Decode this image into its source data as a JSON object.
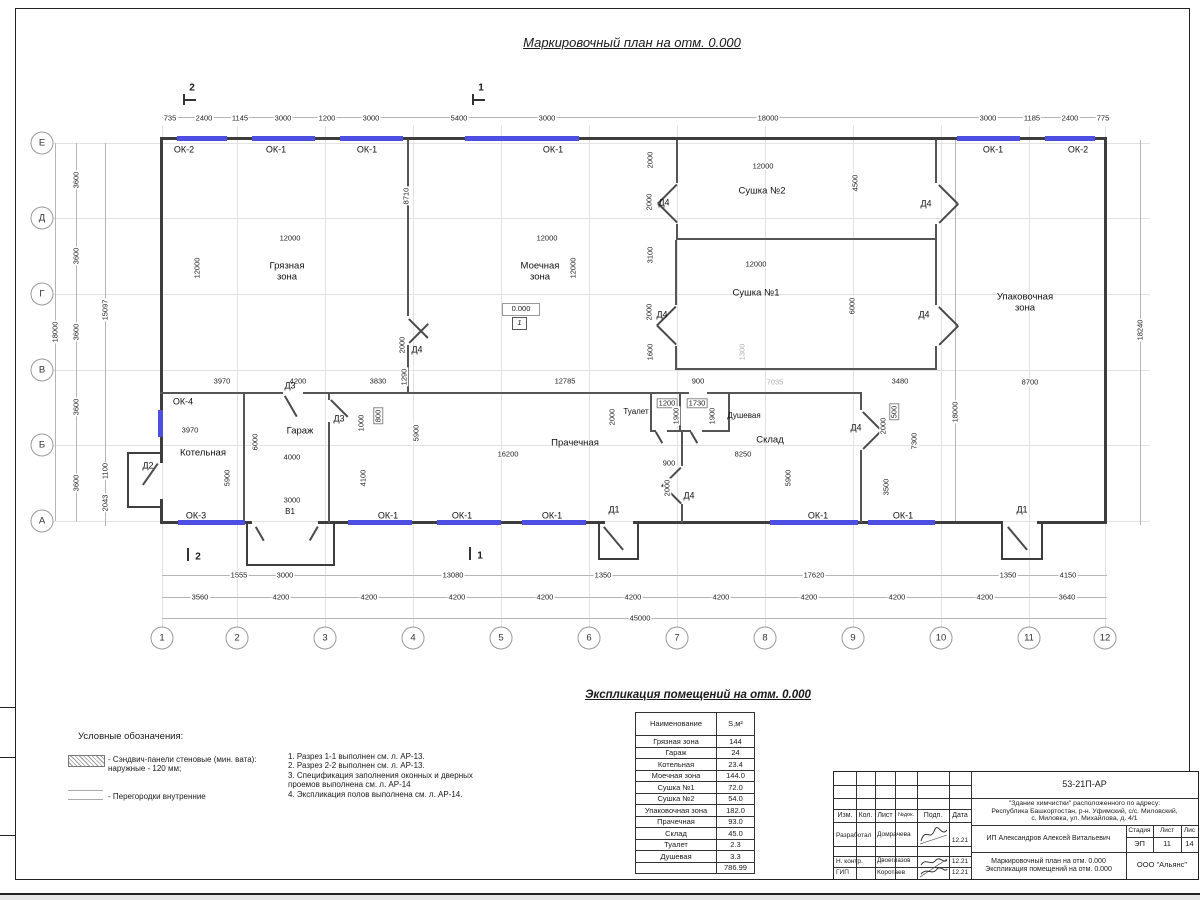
{
  "title": "Маркировочный план на отм. 0.000",
  "plan": {
    "axes_left": [
      {
        "l": "Е",
        "y": 143
      },
      {
        "l": "Д",
        "y": 218
      },
      {
        "l": "Г",
        "y": 294
      },
      {
        "l": "В",
        "y": 370
      },
      {
        "l": "Б",
        "y": 445
      },
      {
        "l": "А",
        "y": 521
      }
    ],
    "axes_bottom": [
      {
        "l": "1",
        "x": 162
      },
      {
        "l": "2",
        "x": 237
      },
      {
        "l": "3",
        "x": 325
      },
      {
        "l": "4",
        "x": 413
      },
      {
        "l": "5",
        "x": 501
      },
      {
        "l": "6",
        "x": 589
      },
      {
        "l": "7",
        "x": 677
      },
      {
        "l": "8",
        "x": 765
      },
      {
        "l": "9",
        "x": 853
      },
      {
        "l": "10",
        "x": 941
      },
      {
        "l": "11",
        "x": 1029
      },
      {
        "l": "12",
        "x": 1105
      }
    ],
    "rooms": [
      {
        "t": "Грязная\nзона",
        "x": 287,
        "y": 272
      },
      {
        "t": "Моечная\nзона",
        "x": 540,
        "y": 272
      },
      {
        "t": "Сушка №2",
        "x": 762,
        "y": 191
      },
      {
        "t": "Сушка №1",
        "x": 756,
        "y": 293
      },
      {
        "t": "Упаковочная\nзона",
        "x": 1025,
        "y": 303
      },
      {
        "t": "Котельная",
        "x": 203,
        "y": 453
      },
      {
        "t": "Гараж",
        "x": 300,
        "y": 431
      },
      {
        "t": "Прачечная",
        "x": 575,
        "y": 443
      },
      {
        "t": "Туалет",
        "x": 636,
        "y": 412,
        "s": 1
      },
      {
        "t": "Душевая",
        "x": 744,
        "y": 416,
        "s": 1
      },
      {
        "t": "Склад",
        "x": 770,
        "y": 440
      },
      {
        "t": "В1",
        "x": 290,
        "y": 512,
        "s": 1
      }
    ],
    "window_tags": [
      {
        "t": "ОК-2",
        "x": 184,
        "y": 150
      },
      {
        "t": "ОК-1",
        "x": 276,
        "y": 150
      },
      {
        "t": "ОК-1",
        "x": 367,
        "y": 150
      },
      {
        "t": "ОК-1",
        "x": 553,
        "y": 150
      },
      {
        "t": "ОК-1",
        "x": 993,
        "y": 150
      },
      {
        "t": "ОК-2",
        "x": 1078,
        "y": 150
      },
      {
        "t": "ОК-4",
        "x": 183,
        "y": 402
      },
      {
        "t": "ОК-3",
        "x": 196,
        "y": 516
      },
      {
        "t": "ОК-1",
        "x": 388,
        "y": 516
      },
      {
        "t": "ОК-1",
        "x": 462,
        "y": 516
      },
      {
        "t": "ОК-1",
        "x": 552,
        "y": 516
      },
      {
        "t": "ОК-1",
        "x": 818,
        "y": 516
      },
      {
        "t": "ОК-1",
        "x": 903,
        "y": 516
      }
    ],
    "door_tags": [
      {
        "t": "Д2",
        "x": 148,
        "y": 466
      },
      {
        "t": "Д3",
        "x": 290,
        "y": 386
      },
      {
        "t": "Д3",
        "x": 339,
        "y": 419
      },
      {
        "t": "Д4",
        "x": 417,
        "y": 350
      },
      {
        "t": "Д4",
        "x": 664,
        "y": 203
      },
      {
        "t": "Д4",
        "x": 926,
        "y": 204
      },
      {
        "t": "Д4",
        "x": 662,
        "y": 315
      },
      {
        "t": "Д4",
        "x": 924,
        "y": 315
      },
      {
        "t": "Д4",
        "x": 689,
        "y": 496
      },
      {
        "t": "Д4",
        "x": 856,
        "y": 428
      },
      {
        "t": "Д1",
        "x": 614,
        "y": 510
      },
      {
        "t": "Д1",
        "x": 1022,
        "y": 510
      }
    ],
    "dims": [
      {
        "t": "735",
        "x": 170,
        "y": 118
      },
      {
        "t": "2400",
        "x": 204,
        "y": 118
      },
      {
        "t": "1145",
        "x": 240,
        "y": 118
      },
      {
        "t": "3000",
        "x": 283,
        "y": 118
      },
      {
        "t": "1200",
        "x": 327,
        "y": 118
      },
      {
        "t": "3000",
        "x": 371,
        "y": 118
      },
      {
        "t": "5400",
        "x": 459,
        "y": 118
      },
      {
        "t": "3000",
        "x": 547,
        "y": 118
      },
      {
        "t": "18000",
        "x": 768,
        "y": 118
      },
      {
        "t": "3000",
        "x": 988,
        "y": 118
      },
      {
        "t": "1185",
        "x": 1032,
        "y": 118
      },
      {
        "t": "2400",
        "x": 1070,
        "y": 118
      },
      {
        "t": "775",
        "x": 1103,
        "y": 118
      },
      {
        "t": "1555",
        "x": 239,
        "y": 575
      },
      {
        "t": "3000",
        "x": 285,
        "y": 575
      },
      {
        "t": "13080",
        "x": 453,
        "y": 575
      },
      {
        "t": "1350",
        "x": 603,
        "y": 575
      },
      {
        "t": "17620",
        "x": 814,
        "y": 575
      },
      {
        "t": "1350",
        "x": 1008,
        "y": 575
      },
      {
        "t": "4150",
        "x": 1068,
        "y": 575
      },
      {
        "t": "3560",
        "x": 200,
        "y": 597
      },
      {
        "t": "4200",
        "x": 281,
        "y": 597
      },
      {
        "t": "4200",
        "x": 369,
        "y": 597
      },
      {
        "t": "4200",
        "x": 457,
        "y": 597
      },
      {
        "t": "4200",
        "x": 545,
        "y": 597
      },
      {
        "t": "4200",
        "x": 633,
        "y": 597
      },
      {
        "t": "4200",
        "x": 721,
        "y": 597
      },
      {
        "t": "4200",
        "x": 809,
        "y": 597
      },
      {
        "t": "4200",
        "x": 897,
        "y": 597
      },
      {
        "t": "4200",
        "x": 985,
        "y": 597
      },
      {
        "t": "3640",
        "x": 1067,
        "y": 597
      },
      {
        "t": "45000",
        "x": 640,
        "y": 618
      },
      {
        "t": "18000",
        "x": 55,
        "y": 332,
        "r": 1
      },
      {
        "t": "3600",
        "x": 76,
        "y": 180,
        "r": 1
      },
      {
        "t": "3600",
        "x": 76,
        "y": 256,
        "r": 1
      },
      {
        "t": "3600",
        "x": 76,
        "y": 332,
        "r": 1
      },
      {
        "t": "3600",
        "x": 76,
        "y": 407,
        "r": 1
      },
      {
        "t": "3600",
        "x": 76,
        "y": 483,
        "r": 1
      },
      {
        "t": "15097",
        "x": 105,
        "y": 310,
        "r": 1
      },
      {
        "t": "1100",
        "x": 105,
        "y": 471,
        "r": 1
      },
      {
        "t": "2043",
        "x": 105,
        "y": 503,
        "r": 1
      },
      {
        "t": "18240",
        "x": 1140,
        "y": 330,
        "r": 1
      },
      {
        "t": "18000",
        "x": 955,
        "y": 412,
        "r": 1
      },
      {
        "t": "12000",
        "x": 197,
        "y": 268,
        "r": 1
      },
      {
        "t": "12000",
        "x": 290,
        "y": 238
      },
      {
        "t": "8710",
        "x": 406,
        "y": 196,
        "r": 1
      },
      {
        "t": "12000",
        "x": 547,
        "y": 238
      },
      {
        "t": "12000",
        "x": 573,
        "y": 268,
        "r": 1
      },
      {
        "t": "2000",
        "x": 650,
        "y": 160,
        "r": 1
      },
      {
        "t": "2000",
        "x": 649,
        "y": 202,
        "r": 1
      },
      {
        "t": "12000",
        "x": 763,
        "y": 166
      },
      {
        "t": "4500",
        "x": 855,
        "y": 183,
        "r": 1
      },
      {
        "t": "3100",
        "x": 650,
        "y": 255,
        "r": 1
      },
      {
        "t": "2000",
        "x": 649,
        "y": 312,
        "r": 1
      },
      {
        "t": "1600",
        "x": 650,
        "y": 352,
        "r": 1
      },
      {
        "t": "12000",
        "x": 756,
        "y": 264
      },
      {
        "t": "6000",
        "x": 852,
        "y": 306,
        "r": 1
      },
      {
        "t": "1300",
        "x": 742,
        "y": 352,
        "r": 1,
        "g": 1
      },
      {
        "t": "3970",
        "x": 222,
        "y": 381
      },
      {
        "t": "4200",
        "x": 298,
        "y": 381
      },
      {
        "t": "3830",
        "x": 378,
        "y": 381
      },
      {
        "t": "12785",
        "x": 565,
        "y": 381
      },
      {
        "t": "900",
        "x": 698,
        "y": 381
      },
      {
        "t": "7035",
        "x": 775,
        "y": 382,
        "g": 1
      },
      {
        "t": "3480",
        "x": 900,
        "y": 381
      },
      {
        "t": "8700",
        "x": 1030,
        "y": 382
      },
      {
        "t": "1290",
        "x": 404,
        "y": 377,
        "r": 1
      },
      {
        "t": "2000",
        "x": 402,
        "y": 345,
        "r": 1
      },
      {
        "t": "3970",
        "x": 190,
        "y": 430
      },
      {
        "t": "5900",
        "x": 227,
        "y": 478,
        "r": 1
      },
      {
        "t": "6000",
        "x": 255,
        "y": 442,
        "r": 1
      },
      {
        "t": "4000",
        "x": 292,
        "y": 457
      },
      {
        "t": "3000",
        "x": 292,
        "y": 500
      },
      {
        "t": "1000",
        "x": 361,
        "y": 423,
        "r": 1
      },
      {
        "t": "800",
        "x": 378,
        "y": 416,
        "r": 1,
        "b": 1
      },
      {
        "t": "4100",
        "x": 363,
        "y": 478,
        "r": 1
      },
      {
        "t": "5900",
        "x": 416,
        "y": 433,
        "r": 1
      },
      {
        "t": "16200",
        "x": 508,
        "y": 454
      },
      {
        "t": "2000",
        "x": 612,
        "y": 417,
        "r": 1
      },
      {
        "t": "1200",
        "x": 667,
        "y": 403,
        "b": 1
      },
      {
        "t": "1730",
        "x": 697,
        "y": 403,
        "b": 1
      },
      {
        "t": "1900",
        "x": 676,
        "y": 416,
        "r": 1
      },
      {
        "t": "1900",
        "x": 712,
        "y": 416,
        "r": 1
      },
      {
        "t": "900",
        "x": 669,
        "y": 463
      },
      {
        "t": "2000",
        "x": 667,
        "y": 488,
        "r": 1
      },
      {
        "t": "8250",
        "x": 743,
        "y": 454
      },
      {
        "t": "5900",
        "x": 788,
        "y": 478,
        "r": 1
      },
      {
        "t": "500",
        "x": 894,
        "y": 412,
        "r": 1,
        "b": 1
      },
      {
        "t": "2000",
        "x": 883,
        "y": 426,
        "r": 1
      },
      {
        "t": "3500",
        "x": 886,
        "y": 487,
        "r": 1
      },
      {
        "t": "7300",
        "x": 914,
        "y": 441,
        "r": 1
      }
    ],
    "section_marks": [
      {
        "t": "2",
        "x": 192,
        "y": 88,
        "p": "top"
      },
      {
        "t": "1",
        "x": 481,
        "y": 88,
        "p": "top"
      },
      {
        "t": "2",
        "x": 198,
        "y": 557,
        "p": "bot"
      },
      {
        "t": "1",
        "x": 480,
        "y": 556,
        "p": "bot"
      }
    ],
    "elevation": {
      "value": "0.000",
      "floor": "1"
    }
  },
  "legend": {
    "title": "Условные обозначения:",
    "item1_line1": "- Сэндвич-панели стеновые (мин. вата):",
    "item1_line2": "наружные - 120 мм;",
    "item2_line1": "- Перегородки внутренние"
  },
  "notes": [
    "1. Разрез 1-1 выполнен см. л. АР-13.",
    "2. Разрез 2-2 выполнен см. л. АР-13.",
    "3. Спецификация заполнения оконных и дверных",
    "проемов выполнена см. л. АР-14",
    "4. Экспликация полов выполнена см. л. АР-14."
  ],
  "expl_table": {
    "title": "Экспликация помещений на отм. 0.000",
    "col_name": "Наименование",
    "col_area": "S,м²",
    "rows": [
      [
        "Грязная зона",
        "144"
      ],
      [
        "Гараж",
        "24"
      ],
      [
        "Котельная",
        "23.4"
      ],
      [
        "Моечная зона",
        "144.0"
      ],
      [
        "Сушка №1",
        "72.0"
      ],
      [
        "Сушка №2",
        "54.0"
      ],
      [
        "Упаковочная зона",
        "182.0"
      ],
      [
        "Прачечная",
        "93.0"
      ],
      [
        "Склад",
        "45.0"
      ],
      [
        "Туалет",
        "2.3"
      ],
      [
        "Душевая",
        "3.3"
      ],
      [
        "",
        "786.99"
      ]
    ]
  },
  "titleblock": {
    "code": "53-21П-АР",
    "address1": "\"Здание химчистки\" расположенного по адресу:",
    "address2": "Республика Башкортостан, р-н. Уфимский, с/с. Миловский,",
    "address3": "с. Миловка, ул. Михайлова, д. 4/1",
    "h_izm": "Изм.",
    "h_kol": "Кол.",
    "h_list": "Лист",
    "h_ndok": "№док.",
    "h_podp": "Подп.",
    "h_data": "Дата",
    "role1": "Разработал",
    "name1": "Домрачева",
    "date1": "12.21",
    "role2": "Н. контр.",
    "name2": "Двоеглазов",
    "date2": "12.21",
    "role3": "ГИП",
    "name3": "Коротаев",
    "date3": "12.21",
    "client": "ИП Александров Алексей Витальевич",
    "stage_label": "Стадия",
    "sheet_label": "Лист",
    "sheets_label": "Лис",
    "stage": "ЭП",
    "sheet": "11",
    "sheets": "14",
    "doc_title1": "Маркировочный план на отм. 0.000",
    "doc_title2": "Экспликация помещений на отм. 0.000",
    "company": "ООО \"Альянс\""
  }
}
